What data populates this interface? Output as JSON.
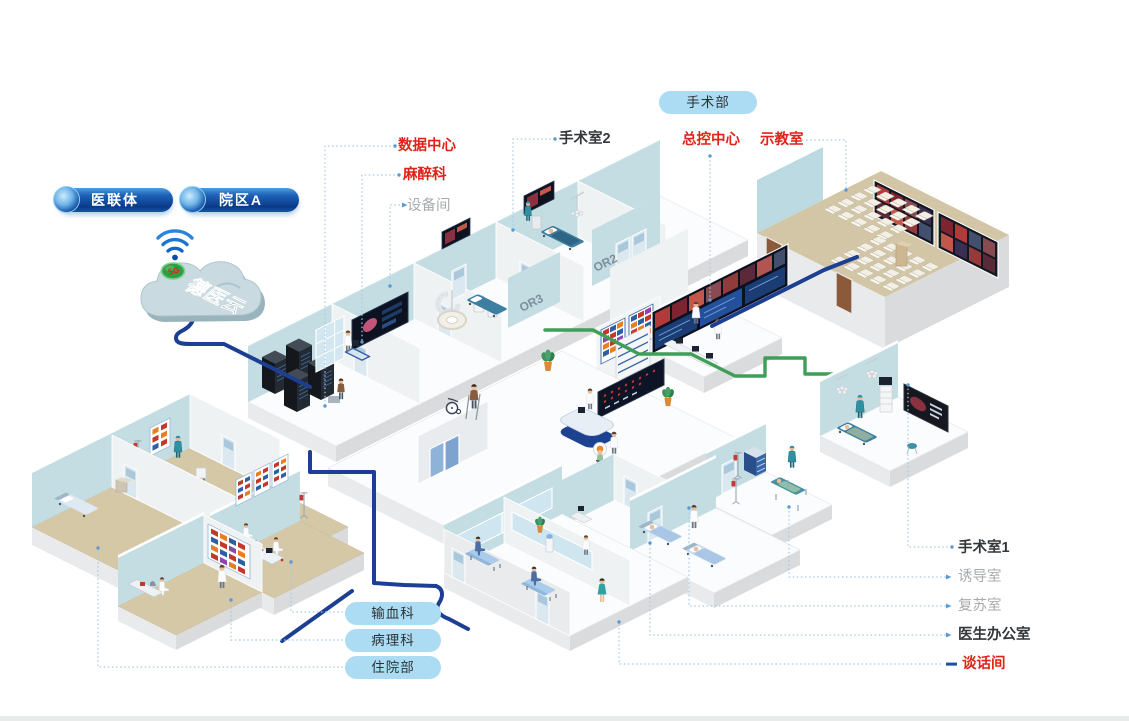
{
  "pills": {
    "consortium": {
      "label": "医联体"
    },
    "campus": {
      "label": "院区A"
    },
    "surgery_dept": {
      "label": "手术部"
    },
    "blood": {
      "label": "输血科"
    },
    "pathology": {
      "label": "病理科"
    },
    "inpatient": {
      "label": "住院部"
    }
  },
  "cloud": {
    "name": "德医云",
    "badge": "5G"
  },
  "labels": {
    "data_center": "数据中心",
    "anesthesia": "麻醉科",
    "equipment_room": "设备间",
    "operating_room_2": "手术室2",
    "master_control": "总控中心",
    "demo_room": "示教室",
    "operating_room_1": "手术室1",
    "induction_room": "诱导室",
    "recovery_room": "复苏室",
    "doctor_office": "医生办公室",
    "talk_room": "谈话间"
  },
  "wall_text": {
    "or2": "OR2",
    "or3": "OR3"
  },
  "colors": {
    "accent_red": "#e02318",
    "pill_dark_blue": "#0c3e8e",
    "pill_light_blue": "#abdcf4",
    "cable_blue": "#1c3f94",
    "cable_green": "#3f9e57",
    "wall_teal": "#bcdae1",
    "floor_tan": "#d5c8a7",
    "leader_line": "#a3c8e8",
    "label_gray": "#a7abae",
    "label_dark": "#33373a"
  }
}
